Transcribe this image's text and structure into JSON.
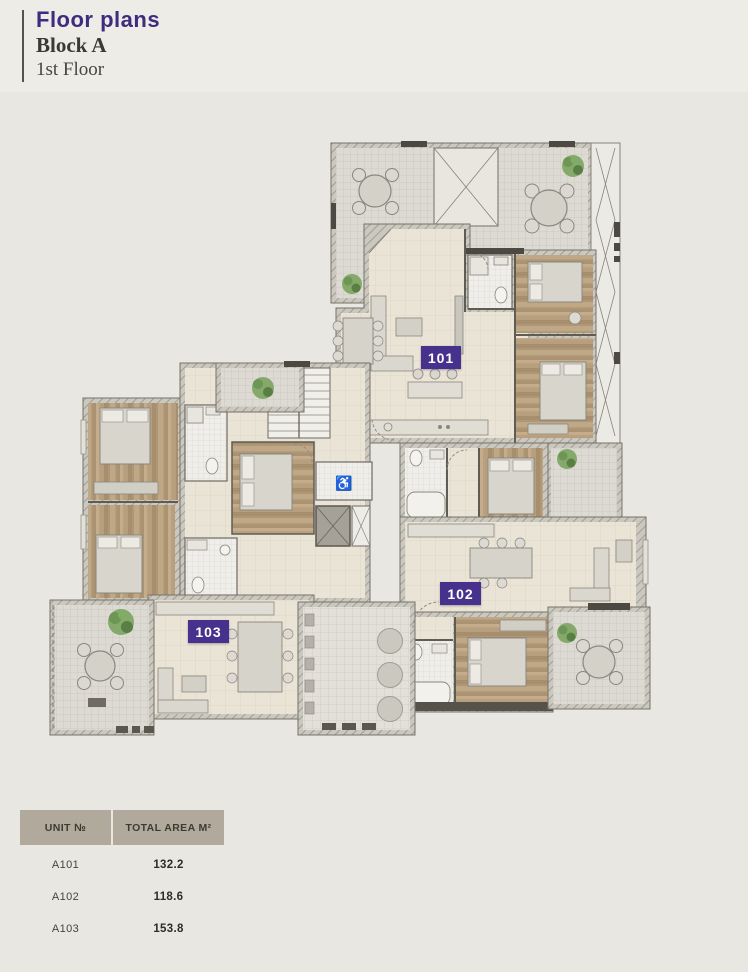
{
  "header": {
    "title": "Floor plans",
    "block": "Block A",
    "floor": "1st Floor"
  },
  "plan": {
    "units": [
      {
        "id": "101",
        "badge": "101"
      },
      {
        "id": "102",
        "badge": "102"
      },
      {
        "id": "103",
        "badge": "103"
      }
    ]
  },
  "table": {
    "headers": {
      "unit": "UNIT №",
      "area": "TOTAL AREA M²"
    },
    "rows": [
      {
        "unit": "A101",
        "area": "132.2"
      },
      {
        "unit": "A102",
        "area": "118.6"
      },
      {
        "unit": "A103",
        "area": "153.8"
      }
    ]
  },
  "colors": {
    "accent_purple": "#46328c",
    "title_purple": "#3e2c7e",
    "table_header_bg": "#b1aa9c",
    "page_bg": "#e9e7e1"
  }
}
